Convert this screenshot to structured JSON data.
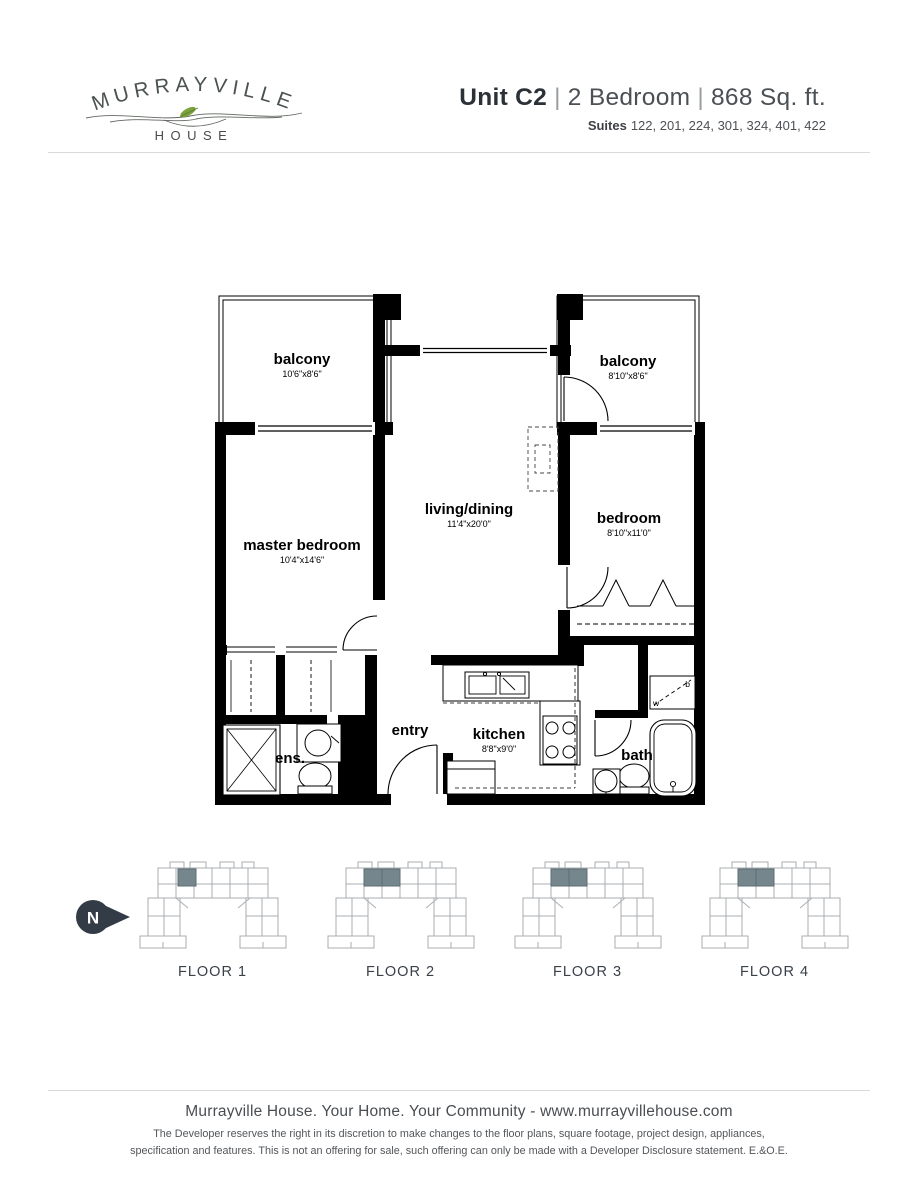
{
  "logo": {
    "name": "MURRAYVILLE",
    "sub": "HOUSE"
  },
  "header": {
    "unit": "Unit C2",
    "separator": "|",
    "type": "2 Bedroom",
    "area": "868 Sq. ft.",
    "suites_label": "Suites",
    "suites": "122, 201, 224, 301, 324, 401, 422"
  },
  "plan": {
    "balcony_left": {
      "name": "balcony",
      "dims": "10'6\"x8'6\""
    },
    "balcony_right": {
      "name": "balcony",
      "dims": "8'10\"x8'6\""
    },
    "master_bedroom": {
      "name": "master bedroom",
      "dims": "10'4\"x14'6\""
    },
    "living_dining": {
      "name": "living/dining",
      "dims": "11'4\"x20'0\""
    },
    "bedroom": {
      "name": "bedroom",
      "dims": "8'10\"x11'0\""
    },
    "entry": {
      "name": "entry"
    },
    "kitchen": {
      "name": "kitchen",
      "dims": "8'8\"x9'0\""
    },
    "ensuite": {
      "name": "ens."
    },
    "bath": {
      "name": "bath"
    },
    "laundry": {
      "top_label": "b",
      "bottom_label": "w"
    }
  },
  "compass": {
    "label": "N"
  },
  "floors": [
    {
      "label": "FLOOR 1"
    },
    {
      "label": "FLOOR 2"
    },
    {
      "label": "FLOOR 3"
    },
    {
      "label": "FLOOR 4"
    }
  ],
  "footer": {
    "tagline": "Murrayville House. Your Home. Your Community - www.murrayvillehouse.com",
    "disclaimer_line1": "The Developer reserves the right in its discretion to make changes to the floor plans, square footage, project design, appliances,",
    "disclaimer_line2": "specification and features. This is not an offering for sale, such offering can only be made with a Developer Disclosure statement. E.&O.E."
  },
  "colors": {
    "wall": "#000000",
    "highlight_unit": "#75868c",
    "plate_outline": "#a9aeb2",
    "compass": "#333b46",
    "logo_leaf": "#7ca23e"
  }
}
